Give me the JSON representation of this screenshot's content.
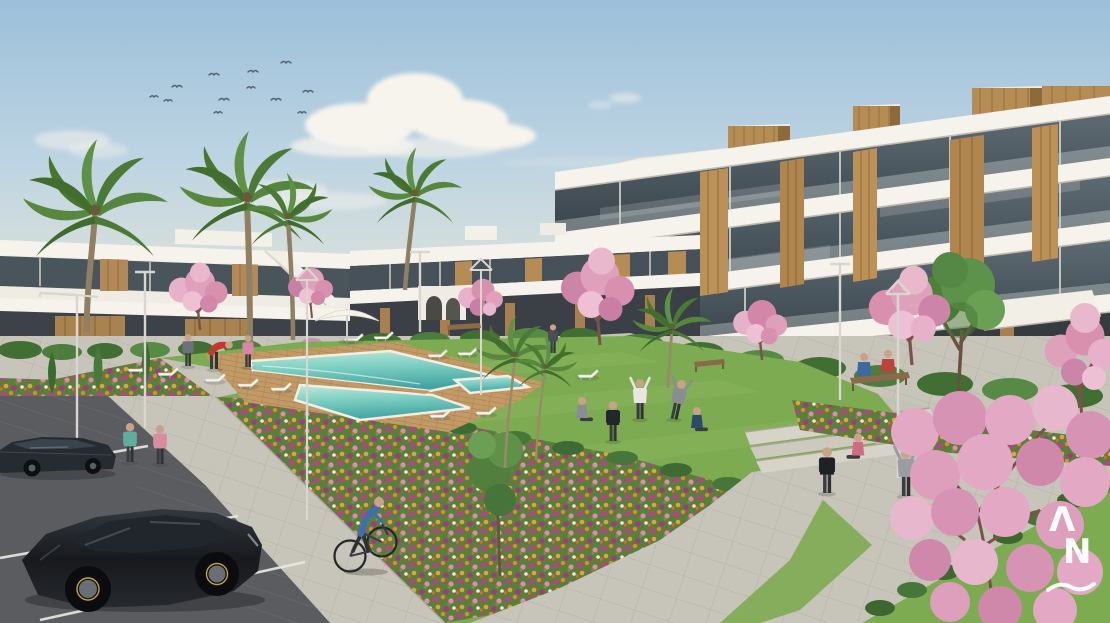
{
  "meta": {
    "title": "Residential complex exterior 3D render",
    "kind": "architectural-visualization",
    "view": "aerial three-quarter view of apartment complex with communal pool garden and parking"
  },
  "watermark": {
    "glyph_top": "Λ",
    "glyph_bottom": "N",
    "shape": "wave-underline",
    "color": "#ffffff"
  },
  "palette": {
    "sky_top": "#9cbfda",
    "sky_horizon": "#eee7d6",
    "cloud": "#f7f4ed",
    "building_white": "#efece4",
    "building_band": "#f6f3ec",
    "building_shade": "#d9d4c9",
    "glass_dark": "#3a454c",
    "wood": "#b68c55",
    "wood_dark": "#94703f",
    "lawn": "#7dab52",
    "lawn_light": "#93bd62",
    "hedge": "#3e6b33",
    "flower_magenta": "#b83f92",
    "flower_orange": "#dd8a35",
    "flower_pink": "#e389b0",
    "blossom_pink": "#e2a8c4",
    "pool_deep": "#43a3a0",
    "pool_shallow": "#bfe9dc",
    "deck_wood": "#c29a66",
    "pavement": "#c7c4b9",
    "asphalt": "#5b5c60",
    "car_dark": "#1c1f24",
    "stall_line": "#e9e9e4"
  },
  "scene": {
    "buildings": {
      "right_block": "four-storey white apartments, wood fins, glass balconies, rooftop wood volumes",
      "left_wing": "two-storey white apartments with roof bulkhead and external stair",
      "center_wing": "two-storey wing with arched garden entrance and awning"
    },
    "amenities": [
      "swimming pool",
      "wooden deck",
      "sun loungers",
      "parasol",
      "lawn",
      "flower beds",
      "benches",
      "street lamps",
      "steps",
      "paved paths",
      "parking"
    ],
    "vegetation": [
      "palm trees",
      "pink blossom trees",
      "green trees",
      "cypresses",
      "hedges",
      "flowering borders"
    ],
    "vehicles": [
      "dark sedan",
      "black hatchback",
      "bicycle"
    ],
    "people_count": 17,
    "birds_count": 12
  }
}
